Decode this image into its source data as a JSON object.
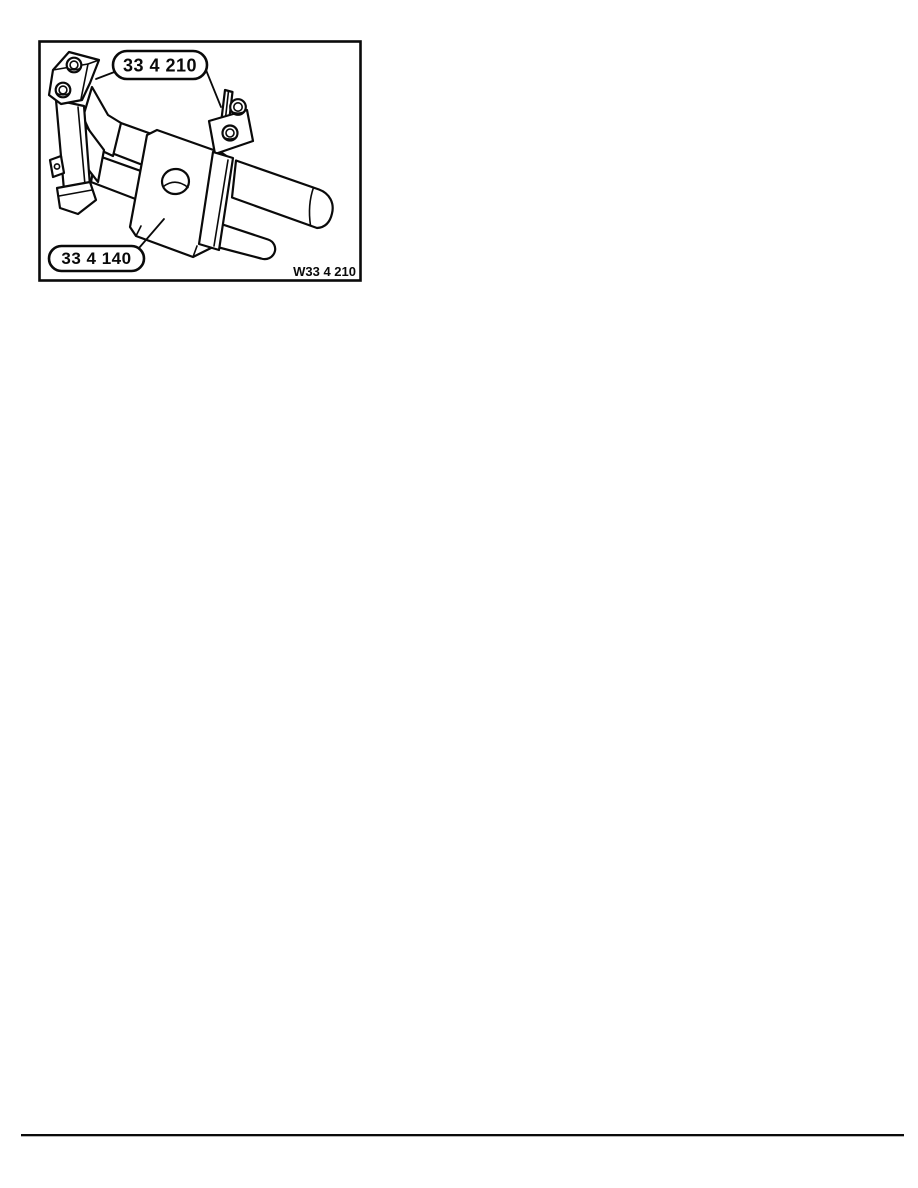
{
  "illustration": {
    "callout_top": "33 4 210",
    "callout_bottom": "33 4 140",
    "figure_code": "W33 4 210",
    "ink_color": "#0a0a0a",
    "background_color": "#ffffff"
  }
}
